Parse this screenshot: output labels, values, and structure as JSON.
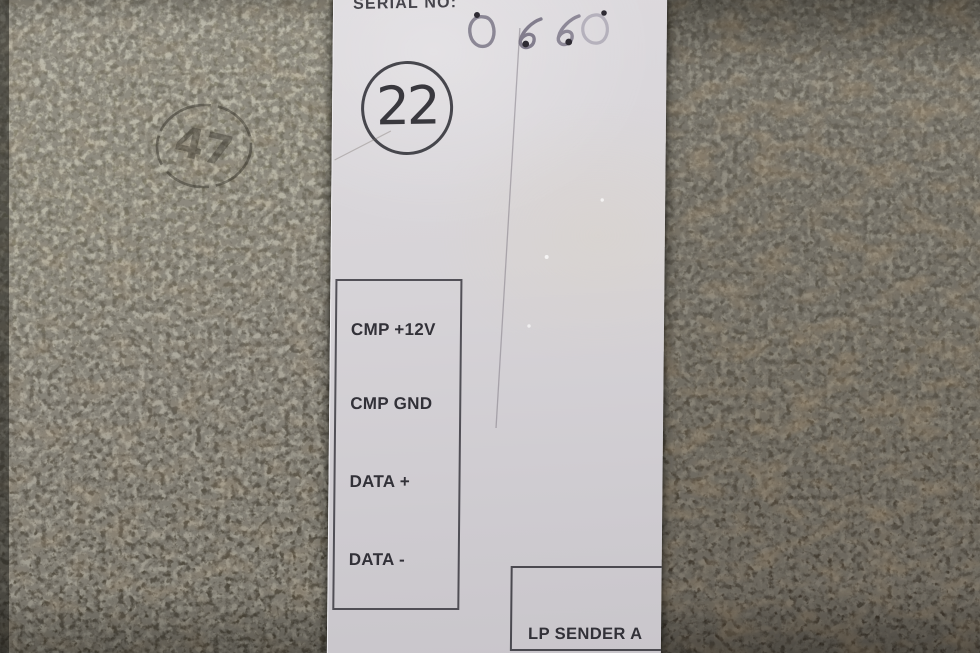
{
  "label": {
    "serial": {
      "field_label": "SERIAL NO:",
      "handwritten_value": "0660"
    },
    "circled_stamp": "22",
    "top_pin_box": {
      "pins": [
        "CMP +12V",
        "CMP GND",
        "DATA +",
        "DATA -"
      ]
    },
    "bottom_pin_box": {
      "pins": [
        "LP SENDER A"
      ]
    }
  },
  "metal_panel": {
    "stamped_circle_number": "47"
  },
  "colors": {
    "label_paper": "#d6d3d7",
    "print_ink": "#35343b",
    "metal_left_top": "#8d8a7b",
    "metal_left_bottom": "#4a4539",
    "metal_right_top": "#6b675c",
    "metal_right_bottom": "#3a332a"
  }
}
